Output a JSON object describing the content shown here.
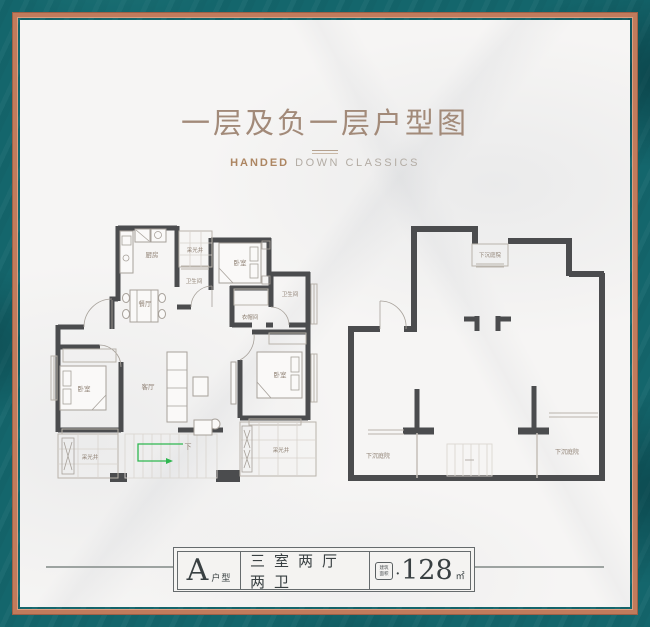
{
  "header": {
    "title": "一层及负一层户型图",
    "brand_bold": "HANDED",
    "brand_rest": "DOWN CLASSICS"
  },
  "plan_left": {
    "labels": {
      "kitchen": "厨房",
      "lightwell_top": "采光井",
      "bathroom_1": "卫生间",
      "bedroom_1": "卧室",
      "dining": "餐厅",
      "cloakroom": "衣帽间",
      "bathroom_2": "卫生间",
      "living": "客厅",
      "bedroom_2": "卧室",
      "bedroom_3": "卧室",
      "lightwell_bottom_left": "采光井",
      "lightwell_bottom_right": "采光井",
      "stairs_down": "下"
    }
  },
  "plan_right": {
    "labels": {
      "courtyard_top": "下沉庭院",
      "courtyard_bottom_left": "下沉庭院",
      "courtyard_bottom_right": "下沉庭院"
    }
  },
  "footer": {
    "unit_letter": "A",
    "unit_suffix": "户型",
    "rooms_text": "三室两厅两卫",
    "area_box_line1": "建筑",
    "area_box_line2": "面积",
    "separator": "•",
    "area_value": "128",
    "area_unit": "㎡"
  },
  "colors": {
    "background_teal": "#14666c",
    "frame_copper": "#c17b5c",
    "marble_white": "#f6f5f4",
    "wall": "#4b4c4e",
    "title_text": "#a28a79",
    "brand_accent": "#ad8662",
    "room_label_text": "#8f8174",
    "stair_arrow_green": "#2fb750",
    "footer_text": "#394042"
  }
}
